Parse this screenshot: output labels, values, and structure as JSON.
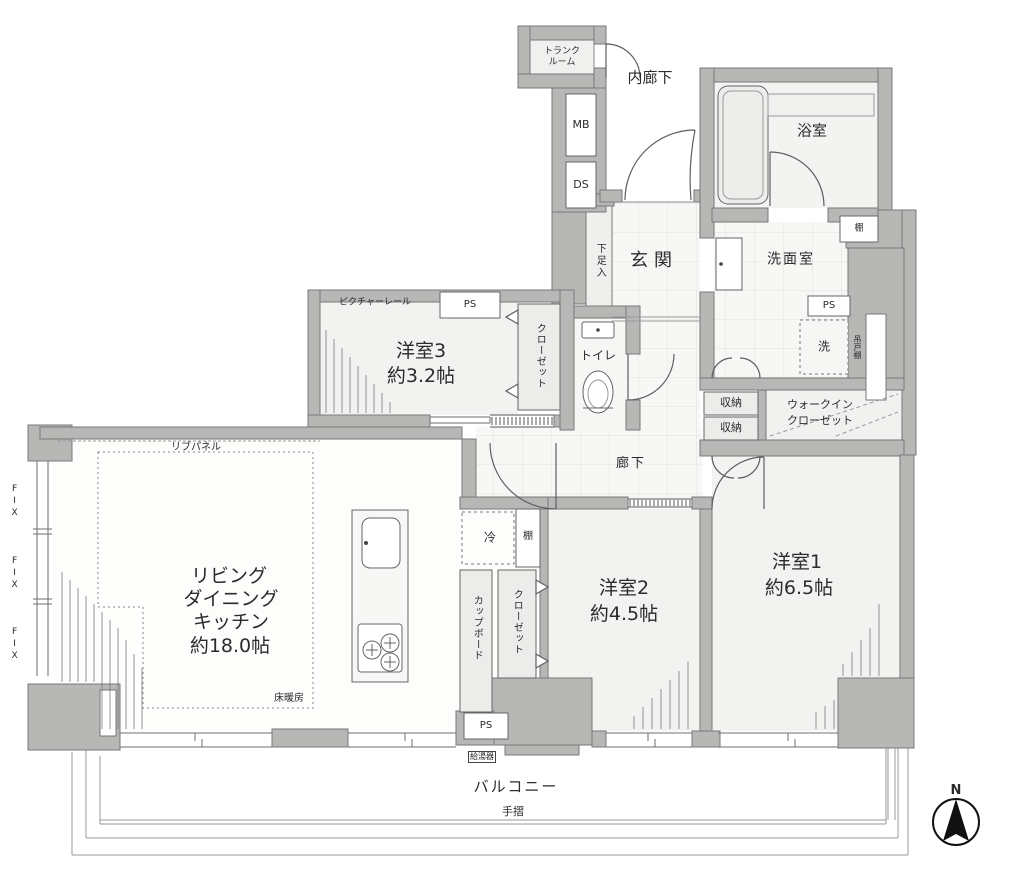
{
  "labels": {
    "trunk_room_1": "トランク",
    "trunk_room_2": "ルーム",
    "inner_corridor": "内廊下",
    "mb": "MB",
    "ds": "DS",
    "bathroom": "浴室",
    "shelf_bath": "棚",
    "entrance": "玄関",
    "shoe_cabinet": "下足入",
    "washroom": "洗面室",
    "ps_washroom": "PS",
    "laundry": "洗",
    "hanging_shelf": "吊戸棚",
    "storage_upper": "収納",
    "storage_lower": "収納",
    "wic_1": "ウォークイン",
    "wic_2": "クローゼット",
    "picture_rail": "ピクチャーレール",
    "ps_room3": "PS",
    "room3_name": "洋室3",
    "room3_size": "約3.2帖",
    "closet_room3": "クローゼット",
    "toilet": "トイレ",
    "hallway": "廊下",
    "rib_panel": "リブパネル",
    "ldk_1": "リビング",
    "ldk_2": "ダイニング",
    "ldk_3": "キッチン",
    "ldk_4": "約18.0帖",
    "floor_heating": "床暖房",
    "fix_1": "FIX",
    "fix_2": "FIX",
    "fix_3": "FIX",
    "refrigerator": "冷",
    "shelf_room2": "棚",
    "room2_name": "洋室2",
    "room2_size": "約4.5帖",
    "closet_room2": "クローゼット",
    "cupboard": "カップボード",
    "ps_bottom": "PS",
    "water_heater": "給湯器",
    "room1_name": "洋室1",
    "room1_size": "約6.5帖",
    "balcony": "バルコニー",
    "handrail": "手摺",
    "north": "N"
  },
  "colors": {
    "wall_fill": "#b7b7b6",
    "wall_outline": "#787878",
    "floor_fill": "#f2f2f1",
    "line": "#6e6e6e",
    "text": "#2b2b2b"
  }
}
